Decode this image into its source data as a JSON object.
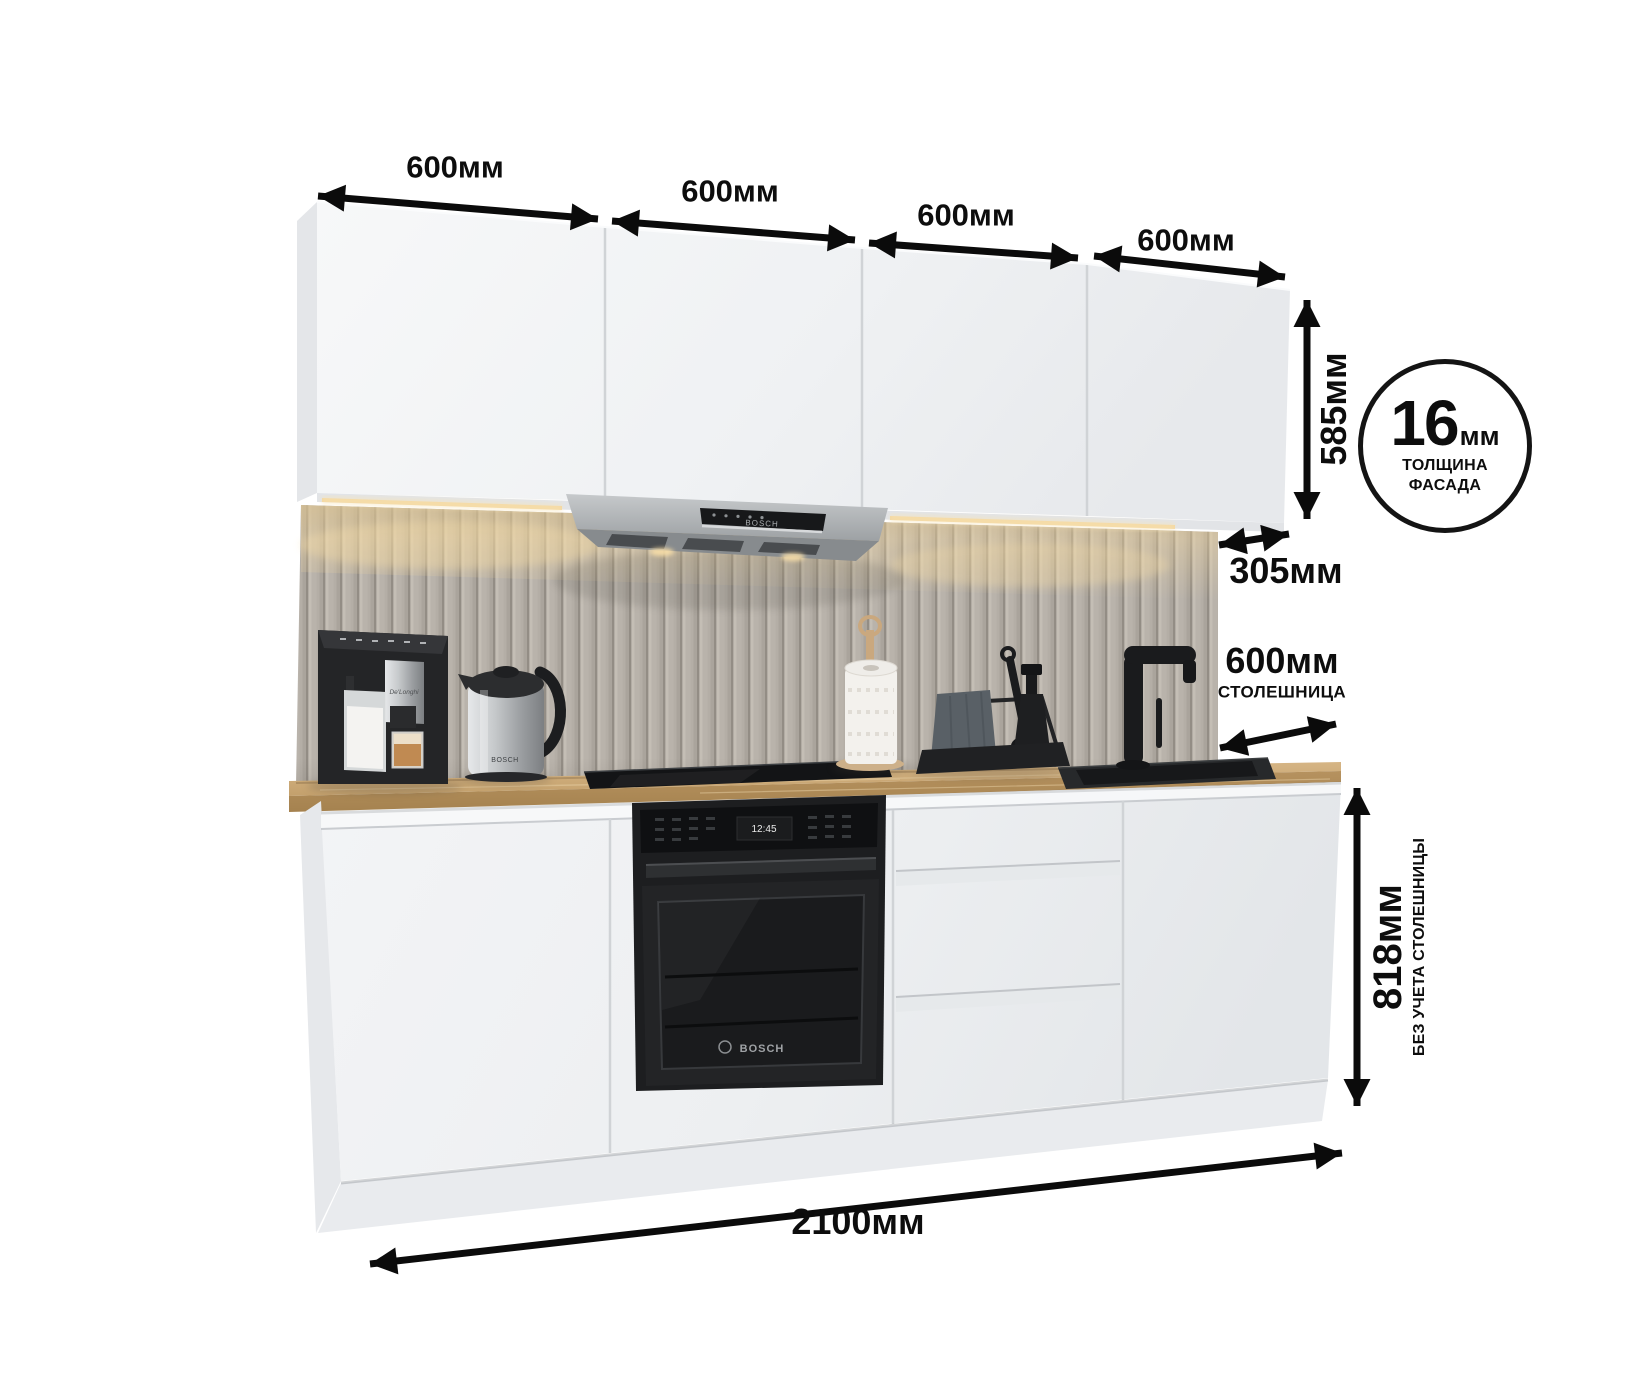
{
  "dimensions": {
    "top_widths": [
      "600мм",
      "600мм",
      "600мм",
      "600мм"
    ],
    "upper_height": "585мм",
    "upper_depth": "305мм",
    "counter_depth": "600мм",
    "counter_depth_note": "СТОЛЕШНИЦА",
    "base_height": "818мм",
    "base_height_note": "БЕЗ УЧЕТА СТОЛЕШНИЦЫ",
    "total_length": "2100мм"
  },
  "badge": {
    "value": "16",
    "unit": "мм",
    "note1": "ТОЛЩИНА",
    "note2": "ФАСАДА"
  },
  "appliances": {
    "hood_brand": "BOSCH",
    "oven_brand": "BOSCH",
    "oven_clock": "12:45",
    "kettle_brand": "BOSCH",
    "coffee_brand": "De'Longhi"
  },
  "colors": {
    "annotation": "#0d0d0d",
    "cabinet_front": "#f1f2f4",
    "backsplash": "#b4aea6",
    "countertop": "#c8a46f",
    "appliance_black": "#1d1e20",
    "hood_gray": "#b3b6b8",
    "led_warm": "#f4d69c"
  }
}
